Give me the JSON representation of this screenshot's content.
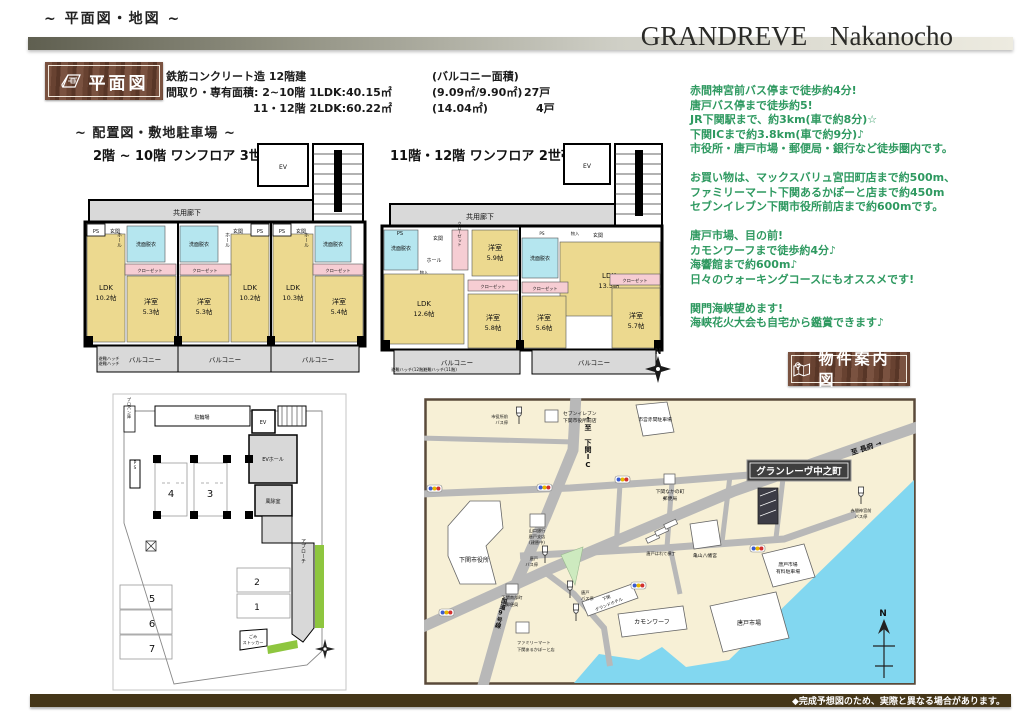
{
  "page": {
    "corner_note": "~ 平面図・地図 ~",
    "brand": "GRANDREVE Nakanocho",
    "footer_note": "◆完成予想図のため、実際と異なる場合があります。"
  },
  "floorplan": {
    "badge": "平面図",
    "construction": "鉄筋コンクリート造 12階建",
    "balcony_header": "(バルコニー面積)",
    "row1": "間取り・専有面積: 2~10階 1LDK:40.15㎡",
    "row1_balcony": "(9.09㎡/9.90㎡)",
    "row1_units": "27戸",
    "row2": "11・12階 2LDK:60.22㎡",
    "row2_balcony": "(14.04㎡)",
    "row2_units": "4戸",
    "layout_note": "~ 配置図・敷地駐車場 ~"
  },
  "plan_a": {
    "title": "2階 ~ 10階 ワンフロア 3世帯",
    "ev": "EV",
    "corridor": "共用廊下",
    "ps": "PS",
    "genkan": "玄関",
    "hall": "ホール",
    "wash": "洗面脱衣",
    "closet": "クローゼット",
    "balcony": "バルコニー",
    "hatch": "避難ハッチ",
    "rooms": [
      {
        "name": "LDK",
        "size": "10.2帖"
      },
      {
        "name": "洋室",
        "size": "5.3帖"
      },
      {
        "name": "洋室",
        "size": "5.3帖"
      },
      {
        "name": "LDK",
        "size": "10.2帖"
      },
      {
        "name": "LDK",
        "size": "10.3帖"
      },
      {
        "name": "洋室",
        "size": "5.4帖"
      }
    ]
  },
  "plan_b": {
    "title": "11階・12階 ワンフロア 2世帯",
    "ev": "EV",
    "corridor": "共用廊下",
    "ps": "PS",
    "genkan": "玄関",
    "hall": "ホール",
    "hallway": "廊下",
    "wash1": "洗面脱衣",
    "wash2": "洗面脱衣",
    "closet": "クローゼット",
    "monoire": "物入",
    "balcony": "バルコニー",
    "hatch12": "避難ハッチ(12階)",
    "hatch11": "避難ハッチ(11階)",
    "north": "N",
    "rooms": [
      {
        "name": "洋室",
        "size": "5.9帖"
      },
      {
        "name": "LDK",
        "size": "12.6帖"
      },
      {
        "name": "洋室",
        "size": "5.8帖"
      },
      {
        "name": "洋室",
        "size": "5.6帖"
      },
      {
        "name": "LDK",
        "size": "13.5帖"
      },
      {
        "name": "洋室",
        "size": "5.7帖"
      }
    ]
  },
  "site": {
    "bicycle": "駐輪場",
    "propane": "プロパン庫",
    "ev": "EV",
    "ev_hall": "EVホール",
    "windbreak": "風除室",
    "approach": "アプローチ",
    "ps": "PS",
    "garbage_1": "ごみ",
    "garbage_2": "ストッカー",
    "stalls": [
      "4",
      "3",
      "2",
      "1",
      "5",
      "6",
      "7"
    ]
  },
  "access": {
    "color": "#2e9960",
    "lines": [
      "赤間神宮前バス停まで徒歩約4分!",
      "唐戸バス停まで徒歩約5!",
      "JR下関駅まで、約3km(車で約8分)☆",
      "下関ICまで約3.8km(車で約9分)♪",
      "市役所・唐戸市場・郵便局・銀行など徒歩圏内です。",
      "",
      "お買い物は、マックスバリュ宮田町店まで約500m、",
      "ファミリーマート下関あるかぽーと店まで約450m",
      "セブンイレブン下関市役所前店まで約600mです。",
      "",
      "唐戸市場、目の前!",
      "カモンワーフまで徒歩約4分♪",
      "海響館まで約600m♪",
      "日々のウォーキングコースにもオススメです!",
      "",
      "関門海峡望めます!",
      "海峡花火大会も自宅から鑑賞できます♪"
    ]
  },
  "map": {
    "badge": "物件案内図",
    "property": "グランレーヴ中之町",
    "labels": {
      "city_hall": "下関市役所",
      "seven_1": "セブンイレブン",
      "seven_2": "下関市役所前店",
      "city_parking": "市営赤間駐車場",
      "post_north_1": "下関なかの町",
      "post_north_2": "郵便局",
      "to_ic": "↑至 下関IC",
      "bank_1": "山口銀行",
      "bank_2": "唐戸支店",
      "bank_3": "(建替中)",
      "karato_bus_1": "唐戸",
      "karato_bus_2": "バス停",
      "yokocho": "唐戸はれて横丁",
      "shrine": "亀山八幡宮",
      "akama_bus_1": "赤間神宮前",
      "akama_bus_2": "バス停",
      "to_chofu": "至 長府 →",
      "karato_parking_1": "唐戸市場",
      "karato_parking_2": "有料駐車場",
      "karato_market": "唐戸市場",
      "post_south_1": "下関南部町",
      "post_south_2": "郵便局",
      "hotel_1": "下関",
      "hotel_2": "グランドホテル",
      "famima_1": "ファミリーマート",
      "famima_2": "下関あるかぽーと店",
      "kamon": "カモンワーフ",
      "route9": "国道9号線",
      "cityhall_bus_1": "市役所前",
      "cityhall_bus_2": "バス停",
      "north": "N"
    }
  },
  "colors": {
    "wood_badge": "#684231",
    "access_green": "#2e9960",
    "footer_brown": "#453618",
    "room_tan": "#ecd98f",
    "wet_blue": "#b5e6ef",
    "closet_pink": "#f6cdd3",
    "corridor_gray": "#d9d9d9",
    "map_land": "#f7f0d6",
    "map_water": "#82d7f0",
    "map_road": "#b8b8b8",
    "site_green": "#8ec63f"
  }
}
